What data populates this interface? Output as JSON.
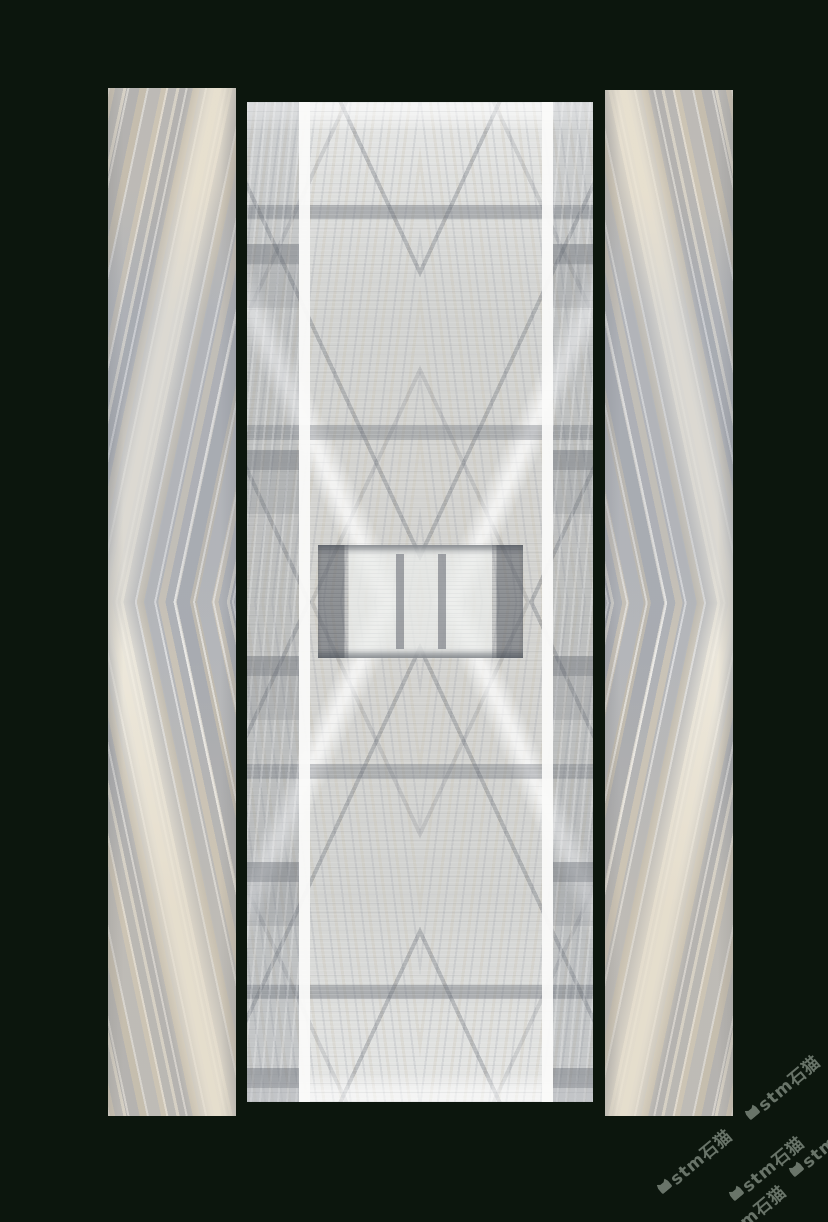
{
  "scene": {
    "background_color": "#0c160d",
    "panel_count": 3,
    "panels": [
      "marble-slab-left",
      "marble-slab-center",
      "marble-slab-right"
    ],
    "marble_palette": [
      "#d2d3d1",
      "#b3b5b8",
      "#efe9db",
      "#9aa0aa",
      "#cfc0a4",
      "#fafaf9"
    ],
    "inlay_stripe_color": "#fafaf9"
  },
  "watermark": {
    "text": "stm石猫",
    "logo": "cat-icon",
    "color": "#cedccf",
    "instance_count": 5
  }
}
